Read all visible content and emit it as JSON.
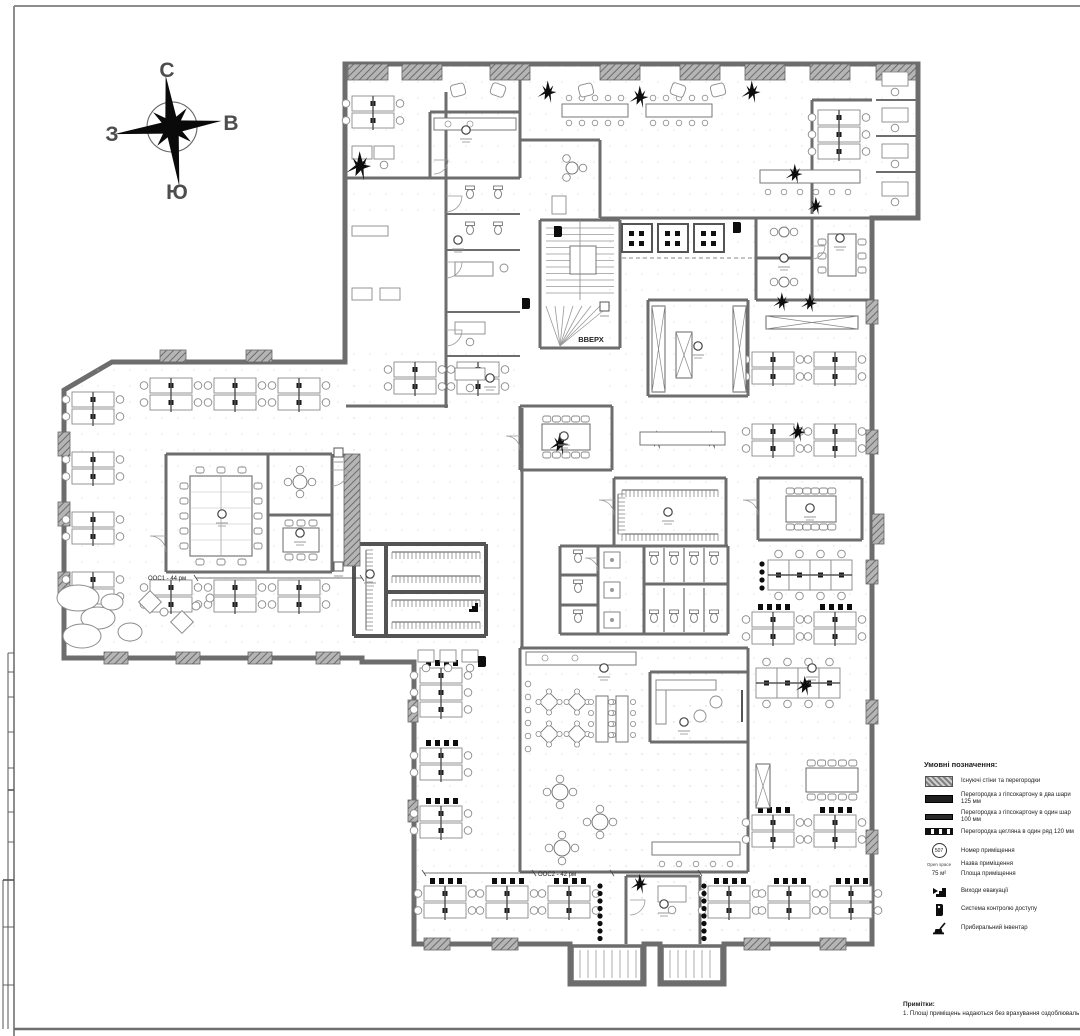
{
  "compass": {
    "north": "С",
    "east": "В",
    "west": "З",
    "south": "Ю"
  },
  "plan_labels": {
    "stair_up": "ВВЕРХ",
    "open_space_1": "ООС1 - 44 рм",
    "open_space_2": "ООС2 - 42 рм"
  },
  "legend": {
    "title": "Умовні позначення:",
    "wall_items": [
      {
        "symbol": "existing-wall",
        "label": "Існуючі стіни та перегородки"
      },
      {
        "symbol": "gypsum-two-layer",
        "label": "Перегородка з гіпсокартону в два шари 125 мм"
      },
      {
        "symbol": "gypsum-one-layer",
        "label": "Перегородка з гіпсокартону в один шар 100 мм"
      },
      {
        "symbol": "brick-single-row",
        "label": "Перегородка цегляна в один ряд 120 мм"
      }
    ],
    "annotation_items": [
      {
        "sample": "507",
        "label": "Номер приміщення"
      },
      {
        "sample": "Open space",
        "label": "Назва приміщення"
      },
      {
        "sample": "75 м²",
        "label": "Площа приміщення"
      }
    ],
    "icon_items": [
      {
        "icon": "evacuation-exit-icon",
        "label": "Виходи евакуації"
      },
      {
        "icon": "access-control-icon",
        "label": "Система контролю доступу"
      },
      {
        "icon": "cleaning-inventory-icon",
        "label": "Прибиральний інвентар"
      }
    ]
  },
  "notes": {
    "title": "Примітки:",
    "items": [
      "1. Площі приміщень надаються без врахування оздоблювальн"
    ]
  },
  "colors": {
    "wall": "#6d6d6d",
    "wall_dark": "#545454",
    "column_fill": "#9a9a9a",
    "furniture": "#8a8a8a",
    "black_item": "#0d0d0d",
    "text": "#3a3a3a",
    "frame": "#8d8d8d",
    "grid_dot": "#c6c6c6"
  }
}
